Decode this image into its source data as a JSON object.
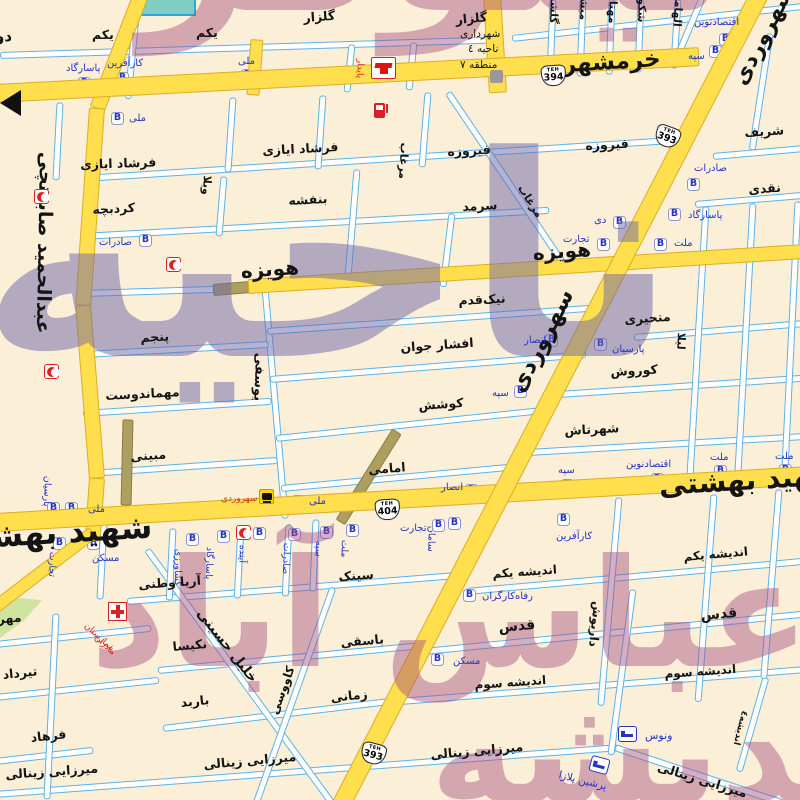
{
  "t": {
    "khorramshahr": "خرمشهر",
    "sohrevardi": "سهروردی",
    "beheshti": "شهید بهشتی",
    "hoveyzeh": "هویزه",
    "sabounchi": "عبدالحمید صابونچی",
    "yekom": "یکم",
    "golzar": "گلزار",
    "farshad": "فرشاد ایازی",
    "firouzeh": "فیروزه",
    "kordbacheh": "کردبچه",
    "banafsheh": "بنفشه",
    "sarmad": "سرمد",
    "villa": "ویلا",
    "morghab": "مرغاب",
    "sharif": "شریف",
    "naghdi": "نقدی",
    "panjom": "پنجم",
    "mehmandoust": "مهماندوست",
    "mobini": "مبینی",
    "yousefi": "یوسفی",
    "nikghadam": "نیک‌قدم",
    "afshar": "افشار جوان",
    "koushesh": "کوشش",
    "emami": "امامی",
    "motahayeri": "متحیری",
    "kourosh": "کوروش",
    "shahrtash": "شهرتاش",
    "leila": "لیلا",
    "andisheh1": "اندیشه یکم",
    "ghods": "قدس",
    "andisheh3": "اندیشه سوم",
    "andisheh4": "اندیشه٤",
    "dariush": "داریوش",
    "aria": "آریا وطنی",
    "sink": "سینک",
    "mehrdad": "مهرداد",
    "tirdad": "تیرداد",
    "farhad": "فرهاد",
    "khalil": "خلیل حسینی",
    "nakisa": "نکیسا",
    "barbod": "باربد",
    "kavousi": "کاووسی",
    "basaghi": "باسقی",
    "zamani": "زمانی",
    "mirzaei": "میرزایی زینالی",
    "dovom": "دوم",
    "golshan": "گلشن",
    "mobasher": "مبشر",
    "mahtab": "مهتاب",
    "shokouh": "شکوه",
    "elhami": "الهامی"
  },
  "b": {
    "b": "B",
    "melli": "ملی",
    "saderat": "صادرات",
    "pasargad": "پاسارگاد",
    "karafarin": "کارآفرین",
    "tejarat": "تجارت",
    "sepah": "سپه",
    "mellat": "ملت",
    "parsian": "پارسیان",
    "ansar": "انصار",
    "dey": "دی",
    "eghtesad": "اقتصادنوین",
    "saman": "سامان",
    "ayandeh": "آینده",
    "keshavarzi": "کشاورزی",
    "maskan": "مسکن",
    "refah": "رفاه‌کارگران"
  },
  "p": {
    "paydar": "پایدار",
    "muni1": "شهرداری",
    "muni2": "ناحیه ٤",
    "muni3": "منطقه ٧",
    "hospital1": "بیمارستان",
    "hospital2": "مادران",
    "venus": "ونوس",
    "plaza": "پرشین پلازا",
    "brt": "سهروردی"
  },
  "sd": {
    "teh": "TEH",
    "n393": "393",
    "n394": "394",
    "n404": "404"
  },
  "w": {
    "top": "نیلوفر",
    "district": "ناحیه",
    "abbas": "عباس آباد",
    "andisheh": "اندیشه"
  },
  "colors": {
    "background": "#fcefd8",
    "road_major": "#ffdf4d",
    "road_casing": "#ddad25",
    "street_casing": "#5db2e4",
    "under_construction": "#ad9f60",
    "bank_blue": "#2433c4",
    "poi_red": "#d62222",
    "watermark_cool": "#6f68a8",
    "watermark_warm": "#a44e7e"
  }
}
